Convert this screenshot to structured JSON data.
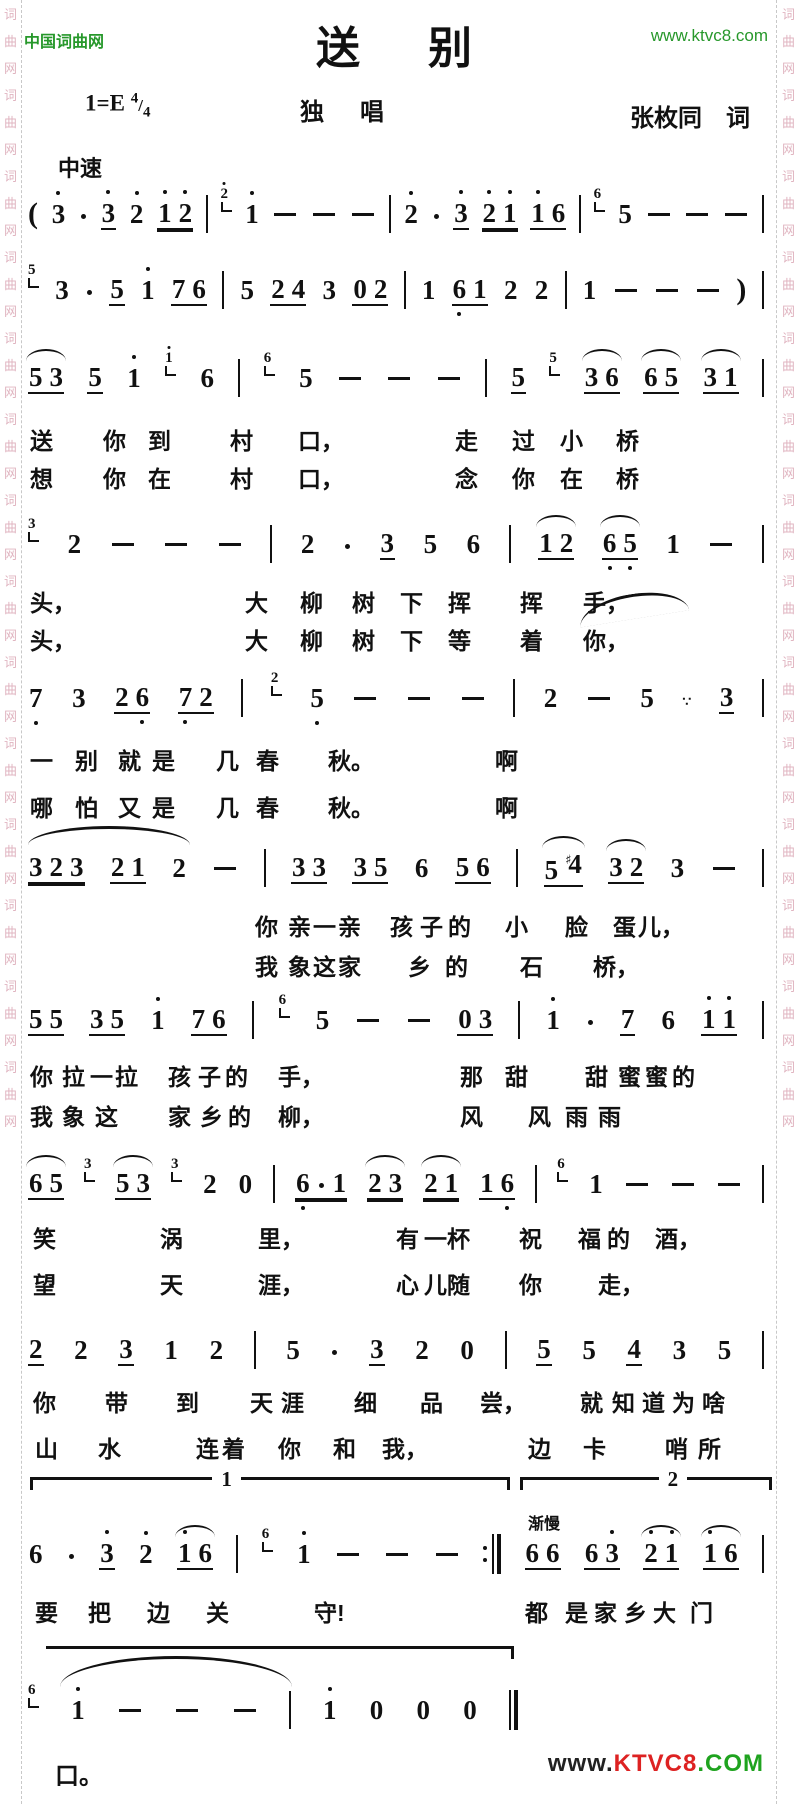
{
  "page": {
    "width": 800,
    "height": 1804,
    "accent_green": "#27982b",
    "watermark_color": "#e0b4c0"
  },
  "watermark": {
    "chars": [
      "词",
      "曲",
      "网"
    ],
    "repeats": 14
  },
  "header": {
    "site_name": "中国词曲网",
    "site_url": "www.ktvc8.com",
    "title": "送　别"
  },
  "meta": {
    "key": "1=E",
    "time_top": "4",
    "time_sep": "/",
    "time_bottom": "4",
    "performance_type": "独　唱",
    "lyricist": "张枚同　词",
    "tempo": "中速"
  },
  "notation": {
    "rall_label": "渐慢",
    "lines": [
      {
        "top": 192,
        "tokens": [
          "(",
          "3'",
          "·",
          "3'_",
          "2'",
          "1'2'=",
          "|",
          "g2'",
          "1'",
          "-",
          "-",
          "-",
          "|",
          "2'",
          "·",
          "3'_",
          "2'1'=",
          "1'6_",
          "|",
          "g6",
          "5",
          "-",
          "-",
          "-",
          "|"
        ]
      },
      {
        "top": 268,
        "tokens": [
          "g5",
          "3",
          "·",
          "5_",
          "1'",
          "76_",
          "|",
          "5",
          "24_",
          "3",
          "02_",
          "|",
          "1",
          "6,1_",
          "2",
          "2",
          "|",
          "1",
          "-",
          "-",
          "-",
          ")",
          "|"
        ]
      },
      {
        "top": 356,
        "tokens": [
          "53~_",
          "5_",
          "1'",
          "g1'",
          "6",
          "|",
          "g6",
          "5",
          "-",
          "-",
          "-",
          "|",
          "5_",
          "g5",
          "36~_",
          "65~_",
          "31~_",
          "|"
        ]
      },
      {
        "top": 522,
        "tokens": [
          "g3",
          "2",
          "-",
          "-",
          "-",
          "|",
          "2",
          "·",
          "3_",
          "5",
          "6",
          "|",
          "12~_",
          "6,5,~_",
          "1",
          "-",
          "|"
        ]
      },
      {
        "top": 676,
        "tokens": [
          "7,",
          "3",
          "26,_",
          "7,2_",
          "|",
          "g2",
          "5,",
          "-",
          "-",
          "-",
          "|",
          "2",
          "-",
          "5",
          "∵",
          "3_",
          "|"
        ]
      },
      {
        "top": 846,
        "tokens": [
          "323=",
          "21_",
          "2",
          "-",
          "|",
          "33_",
          "35_",
          "6",
          "56_",
          "|",
          "5#4~_",
          "32~_",
          "3",
          "-",
          "|"
        ]
      },
      {
        "top": 998,
        "tokens": [
          "55_",
          "35_",
          "1'",
          "76_",
          "|",
          "g6",
          "5",
          "-",
          "-",
          "03_",
          "|",
          "1'",
          "·",
          "7_",
          "6",
          "1'1'_",
          "|"
        ]
      },
      {
        "top": 1162,
        "tokens": [
          "65~_",
          "g3",
          "53~_",
          "g3",
          "2",
          "0",
          "|",
          "6,·1=",
          "23~=",
          "21~=",
          "16,_",
          "|",
          "g6",
          "1",
          "-",
          "-",
          "-",
          "|"
        ]
      },
      {
        "top": 1328,
        "tokens": [
          "2_",
          "2",
          "3_",
          "1",
          "2",
          "|",
          "5",
          "·",
          "3_",
          "2",
          "0",
          "|",
          "5_",
          "5",
          "4_",
          "3",
          "5",
          "|"
        ]
      },
      {
        "top": 1532,
        "tokens": [
          "6",
          "·",
          "3'_",
          "2'",
          "1'6~_",
          "|",
          "g6",
          "1'",
          "-",
          "-",
          "-",
          ":|",
          "66_",
          "63'_",
          "2'1'~_",
          "1'6~_",
          "|"
        ]
      },
      {
        "top": 1688,
        "width": 490,
        "tokens": [
          "g6",
          "1'",
          "-",
          "-",
          "-",
          "|",
          "1'",
          "0",
          "0",
          "0",
          "||"
        ]
      }
    ],
    "slurs": [
      {
        "left": 578,
        "top": 594,
        "width": 110,
        "height": 22,
        "rotate": -9
      },
      {
        "left": 28,
        "top": 826,
        "width": 162,
        "height": 16,
        "rotate": 0
      },
      {
        "left": 60,
        "top": 1656,
        "width": 232,
        "height": 28,
        "rotate": 0
      }
    ]
  },
  "volta": {
    "first": {
      "label": "1",
      "left": 30,
      "width": 480,
      "top": 1477,
      "label_pos": 38,
      "ticks": "both"
    },
    "second": {
      "label": "2",
      "left": 520,
      "width": 252,
      "top": 1477,
      "label_pos": 55,
      "ticks": "both"
    },
    "continuation": {
      "label": "",
      "left": 46,
      "width": 468,
      "top": 1646,
      "label_pos": 0,
      "ticks": "right"
    }
  },
  "lyrics": {
    "rows": [
      {
        "top": 422,
        "items": [
          [
            "送",
            30
          ],
          [
            "你",
            103
          ],
          [
            "到",
            148
          ],
          [
            "村",
            230
          ],
          [
            "口，",
            298
          ],
          [
            "走",
            455
          ],
          [
            "过",
            512
          ],
          [
            "小",
            560
          ],
          [
            "桥",
            616
          ]
        ]
      },
      {
        "top": 460,
        "items": [
          [
            "想",
            30
          ],
          [
            "你",
            103
          ],
          [
            "在",
            148
          ],
          [
            "村",
            230
          ],
          [
            "口，",
            298
          ],
          [
            "念",
            455
          ],
          [
            "你",
            512
          ],
          [
            "在",
            560
          ],
          [
            "桥",
            616
          ]
        ]
      },
      {
        "top": 584,
        "items": [
          [
            "头，",
            30
          ],
          [
            "大",
            245
          ],
          [
            "柳",
            300
          ],
          [
            "树",
            352
          ],
          [
            "下",
            400
          ],
          [
            "挥",
            448
          ],
          [
            "挥",
            520
          ],
          [
            "手，",
            583
          ]
        ]
      },
      {
        "top": 622,
        "items": [
          [
            "头，",
            30
          ],
          [
            "大",
            245
          ],
          [
            "柳",
            300
          ],
          [
            "树",
            352
          ],
          [
            "下",
            400
          ],
          [
            "等",
            448
          ],
          [
            "着",
            520
          ],
          [
            "你，",
            583
          ]
        ]
      },
      {
        "top": 742,
        "items": [
          [
            "一",
            30
          ],
          [
            "别",
            75
          ],
          [
            "就",
            118
          ],
          [
            "是",
            152
          ],
          [
            "几",
            216
          ],
          [
            "春",
            256
          ],
          [
            "秋。",
            328
          ],
          [
            "啊",
            495
          ]
        ]
      },
      {
        "top": 789,
        "items": [
          [
            "哪",
            30
          ],
          [
            "怕",
            75
          ],
          [
            "又",
            118
          ],
          [
            "是",
            152
          ],
          [
            "几",
            216
          ],
          [
            "春",
            256
          ],
          [
            "秋。",
            328
          ],
          [
            "啊",
            495
          ]
        ]
      },
      {
        "top": 908,
        "items": [
          [
            "你",
            255
          ],
          [
            "亲",
            288
          ],
          [
            "一",
            313
          ],
          [
            "亲",
            338
          ],
          [
            "孩",
            390
          ],
          [
            "子",
            420
          ],
          [
            "的",
            448
          ],
          [
            "小",
            505
          ],
          [
            "脸",
            565
          ],
          [
            "蛋",
            613
          ],
          [
            "儿，",
            638
          ]
        ]
      },
      {
        "top": 948,
        "items": [
          [
            "我",
            255
          ],
          [
            "象",
            288
          ],
          [
            "这",
            313
          ],
          [
            "家",
            338
          ],
          [
            "乡",
            408
          ],
          [
            "的",
            445
          ],
          [
            "石",
            520
          ],
          [
            "桥，",
            593
          ]
        ]
      },
      {
        "top": 1058,
        "items": [
          [
            "你",
            30
          ],
          [
            "拉",
            62
          ],
          [
            "一",
            90
          ],
          [
            "拉",
            115
          ],
          [
            "孩",
            168
          ],
          [
            "子",
            198
          ],
          [
            "的",
            225
          ],
          [
            "手，",
            278
          ],
          [
            "那",
            460
          ],
          [
            "甜",
            505
          ],
          [
            "甜",
            585
          ],
          [
            "蜜",
            618
          ],
          [
            "蜜",
            645
          ],
          [
            "的",
            672
          ]
        ]
      },
      {
        "top": 1098,
        "items": [
          [
            "我",
            30
          ],
          [
            "象",
            62
          ],
          [
            "这",
            95
          ],
          [
            "家",
            168
          ],
          [
            "乡",
            200
          ],
          [
            "的",
            228
          ],
          [
            "柳，",
            278
          ],
          [
            "风",
            460
          ],
          [
            "风",
            528
          ],
          [
            "雨",
            565
          ],
          [
            "雨",
            598
          ]
        ]
      },
      {
        "top": 1220,
        "items": [
          [
            "笑",
            33
          ],
          [
            "涡",
            160
          ],
          [
            "里，",
            258
          ],
          [
            "有",
            396
          ],
          [
            "一",
            424
          ],
          [
            "杯",
            447
          ],
          [
            "祝",
            519
          ],
          [
            "福",
            578
          ],
          [
            "的",
            607
          ],
          [
            "酒，",
            655
          ]
        ]
      },
      {
        "top": 1266,
        "items": [
          [
            "望",
            33
          ],
          [
            "天",
            160
          ],
          [
            "涯，",
            258
          ],
          [
            "心",
            396
          ],
          [
            "儿",
            424
          ],
          [
            "随",
            447
          ],
          [
            "你",
            519
          ],
          [
            "走，",
            598
          ]
        ]
      },
      {
        "top": 1384,
        "items": [
          [
            "你",
            33
          ],
          [
            "带",
            105
          ],
          [
            "到",
            176
          ],
          [
            "天",
            250
          ],
          [
            "涯",
            281
          ],
          [
            "细",
            354
          ],
          [
            "品",
            420
          ],
          [
            "尝，",
            480
          ],
          [
            "就",
            580
          ],
          [
            "知",
            612
          ],
          [
            "道",
            642
          ],
          [
            "为",
            672
          ],
          [
            "啥",
            702
          ]
        ]
      },
      {
        "top": 1430,
        "items": [
          [
            "山",
            35
          ],
          [
            "水",
            98
          ],
          [
            "连",
            196
          ],
          [
            "着",
            222
          ],
          [
            "你",
            278
          ],
          [
            "和",
            333
          ],
          [
            "我，",
            382
          ],
          [
            "边",
            528
          ],
          [
            "卡",
            583
          ],
          [
            "哨",
            665
          ],
          [
            "所",
            698
          ]
        ]
      },
      {
        "top": 1594,
        "items": [
          [
            "要",
            35
          ],
          [
            "把",
            88
          ],
          [
            "边",
            147
          ],
          [
            "关",
            206
          ],
          [
            "守!",
            314
          ],
          [
            "都",
            525
          ],
          [
            "是",
            565
          ],
          [
            "家",
            594
          ],
          [
            "乡",
            624
          ],
          [
            "大",
            653
          ],
          [
            "门",
            690
          ]
        ]
      },
      {
        "top": 1756,
        "items": [
          [
            "口。",
            0
          ]
        ]
      }
    ]
  },
  "footer": {
    "logo_parts": [
      {
        "t": "www.",
        "c": "#222222"
      },
      {
        "t": "KTVC8",
        "c": "#dd2222"
      },
      {
        "t": ".COM",
        "c": "#1fa31f"
      }
    ]
  }
}
